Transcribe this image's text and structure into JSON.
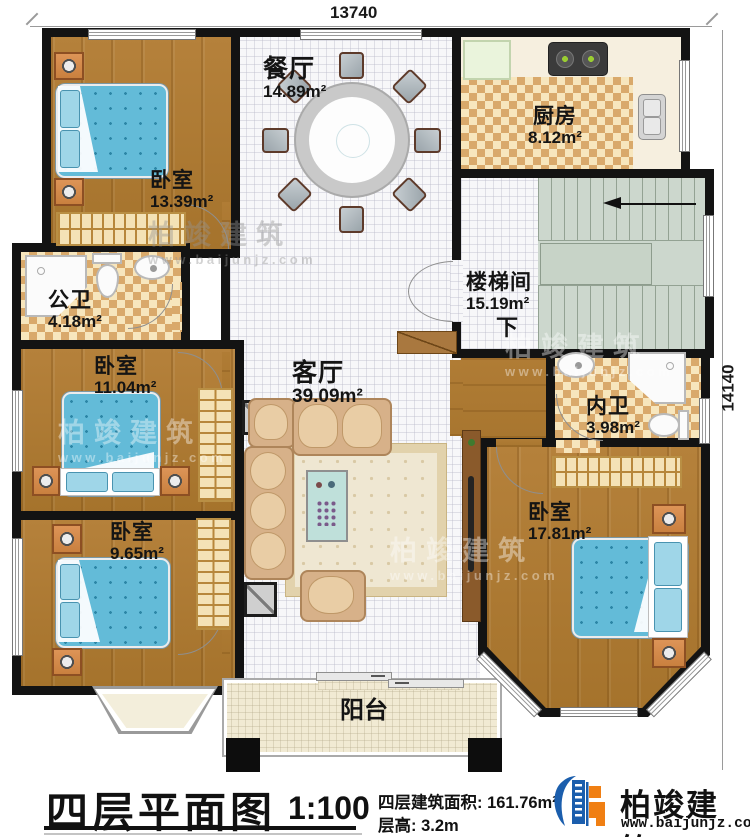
{
  "dimensions": {
    "width_top": "13740",
    "height_right": "14140"
  },
  "rooms": {
    "dining": {
      "name": "餐厅",
      "area": "14.89m²"
    },
    "kitchen": {
      "name": "厨房",
      "area": "8.12m²"
    },
    "bedroom_nw": {
      "name": "卧室",
      "area": "13.39m²"
    },
    "public_bath": {
      "name": "公卫",
      "area": "4.18m²"
    },
    "stairwell": {
      "name": "楼梯间",
      "area": "15.19m²",
      "down": "下"
    },
    "bedroom_w": {
      "name": "卧室",
      "area": "11.04m²"
    },
    "living": {
      "name": "客厅",
      "area": "39.09m²"
    },
    "private_bath": {
      "name": "内卫",
      "area": "3.98m²"
    },
    "bedroom_sw": {
      "name": "卧室",
      "area": "9.65m²"
    },
    "bedroom_se": {
      "name": "卧室",
      "area": "17.81m²"
    },
    "balcony": {
      "name": "阳台"
    }
  },
  "footer": {
    "plan_title": "四层平面图",
    "scale": "1:100",
    "area_line": "四层建筑面积: 161.76m²",
    "floor_height_line": "层高: 3.2m"
  },
  "brand": {
    "name": "柏竣建筑",
    "url": "www.baijunjz.com"
  },
  "watermark": {
    "text": "柏竣建筑",
    "url": "www.baijunjz.com"
  },
  "colors": {
    "wall": "#131313",
    "accent_blue": "#1b5ead",
    "accent_orange": "#f07f13",
    "bed_blue": "#63bbd8"
  }
}
